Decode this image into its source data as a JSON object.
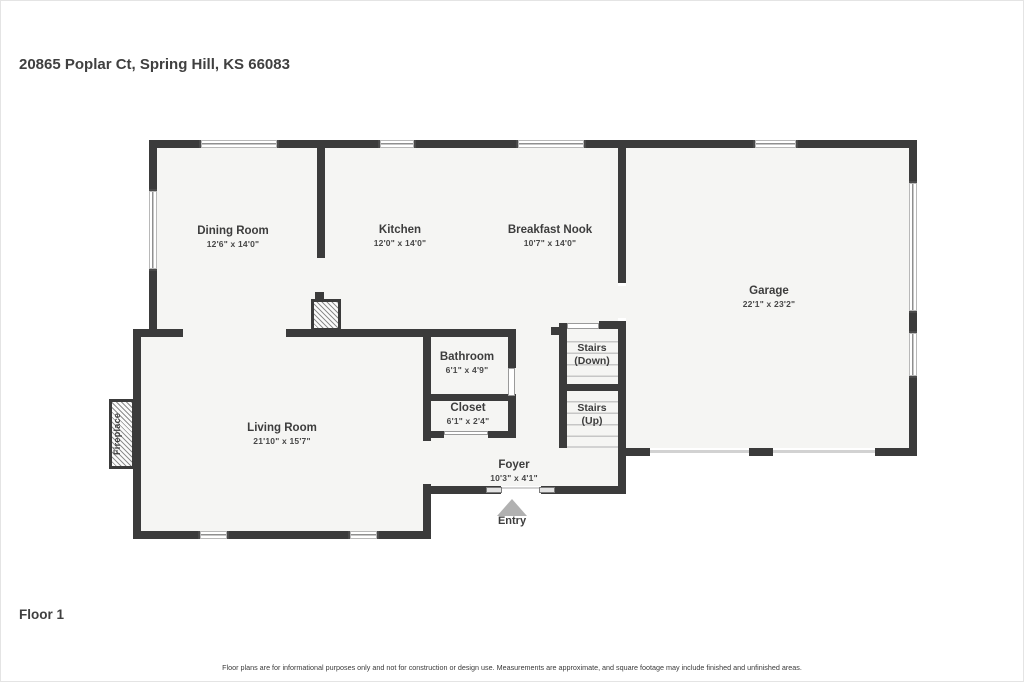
{
  "page": {
    "address": "20865 Poplar Ct, Spring Hill, KS 66083",
    "floor_label": "Floor 1",
    "disclaimer": "Floor plans are for informational purposes only and not for construction or design use. Measurements are approximate, and square footage may include finished and unfinished areas."
  },
  "colors": {
    "wall": "#3b3b3b",
    "floor_fill": "#f5f5f3",
    "text": "#3d3d3d",
    "entry_arrow": "#b1b1b1"
  },
  "rooms": [
    {
      "id": "dining-room",
      "name": "Dining Room",
      "dims": "12'6\" x 14'0\""
    },
    {
      "id": "kitchen",
      "name": "Kitchen",
      "dims": "12'0\" x 14'0\""
    },
    {
      "id": "breakfast-nook",
      "name": "Breakfast Nook",
      "dims": "10'7\" x 14'0\""
    },
    {
      "id": "garage",
      "name": "Garage",
      "dims": "22'1\" x 23'2\""
    },
    {
      "id": "bathroom",
      "name": "Bathroom",
      "dims": "6'1\" x 4'9\""
    },
    {
      "id": "closet",
      "name": "Closet",
      "dims": "6'1\" x 2'4\""
    },
    {
      "id": "living-room",
      "name": "Living Room",
      "dims": "21'10\" x 15'7\""
    },
    {
      "id": "foyer",
      "name": "Foyer",
      "dims": "10'3\" x 4'1\""
    }
  ],
  "stairs": [
    {
      "line1": "Stairs",
      "line2": "(Down)"
    },
    {
      "line1": "Stairs",
      "line2": "(Up)"
    }
  ],
  "annotations": {
    "entry": "Entry",
    "fireplace": "Fireplace"
  }
}
